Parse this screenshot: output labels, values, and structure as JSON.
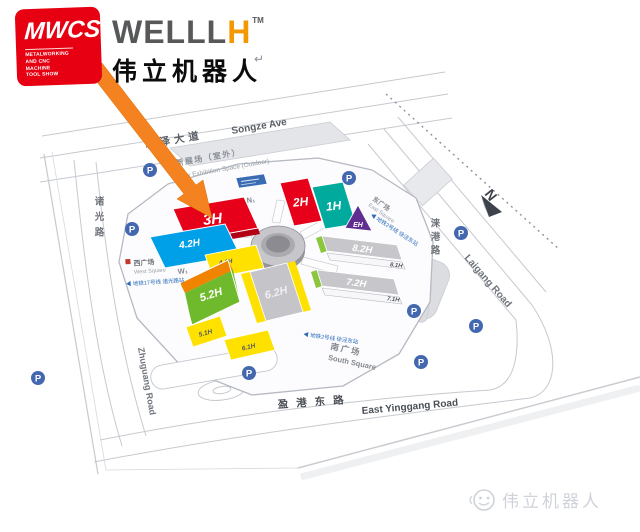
{
  "header": {
    "mwcs": {
      "title": "MWCS",
      "subtitle": "METALWORKING\nAND CNC MACHINE\nTOOL SHOW",
      "logo_bg": "#e60012"
    },
    "brand": {
      "name": "WELLL",
      "accent": "H",
      "tm": "TM",
      "cn": "伟立机器人",
      "accent_color": "#f39800"
    },
    "return_mark": "↵"
  },
  "map": {
    "compass": "N",
    "arrow_color": "#f58220",
    "parking_label": "P",
    "parking_color": "#4468b0",
    "metro_color": "#2a6bb7",
    "palette": {
      "green_strip": "#8cc63f",
      "sign_blue": "#3a6cb4"
    },
    "roads": {
      "songze_cn": "崧泽大道",
      "songze_en": "Songze Ave",
      "laigang_cn": "涞港路",
      "laigang_en": "Laigang Road",
      "zhuguang_cn": "诸光路",
      "zhuguang_en": "Zhuguang Road",
      "yinggang_cn": "盈港东路",
      "yinggang_en": "East Yinggang Road"
    },
    "areas": {
      "new_space_cn": "新展场（室外）",
      "new_space_en": "New Exhibition Space (Outdoor)",
      "west_cn": "西广场",
      "west_en": "West Square",
      "east_cn": "东广场",
      "east_en": "East Square",
      "south_cn": "南广场",
      "south_en": "South Square"
    },
    "metro": {
      "west": "◀ 地铁17号线 诸光路站",
      "east": "◀ 地铁2号线 徐泾东站",
      "south": "◀ 地铁2号线 徐泾东站"
    },
    "entrances": {
      "north": "N₁",
      "west": "W₁"
    },
    "halls": [
      {
        "label": "3H",
        "color": "#e60019"
      },
      {
        "label": "4.2H",
        "color": "#00a0e9"
      },
      {
        "label": "4.1H",
        "color": "#ffe100"
      },
      {
        "label": "2H",
        "color": "#e60019"
      },
      {
        "label": "1H",
        "color": "#00ab9e"
      },
      {
        "label": "EH",
        "color": "#5f2e91"
      },
      {
        "label": "8.2H",
        "color": "#c6c6cb"
      },
      {
        "label": "8.1H",
        "color": "#f7f7f9"
      },
      {
        "label": "7.2H",
        "color": "#c6c6cb"
      },
      {
        "label": "7.1H",
        "color": "#f7f7f9"
      },
      {
        "label": "5.2H",
        "color": "#6fba2c",
        "accent": "#f08300"
      },
      {
        "label": "6.2H",
        "color": "#c4c4c9",
        "accent": "#ffe100"
      },
      {
        "label": "5.1H",
        "color": "#ffe100"
      },
      {
        "label": "6.1H",
        "color": "#ffe100"
      }
    ]
  },
  "footer": {
    "watermark": "伟立机器人"
  }
}
